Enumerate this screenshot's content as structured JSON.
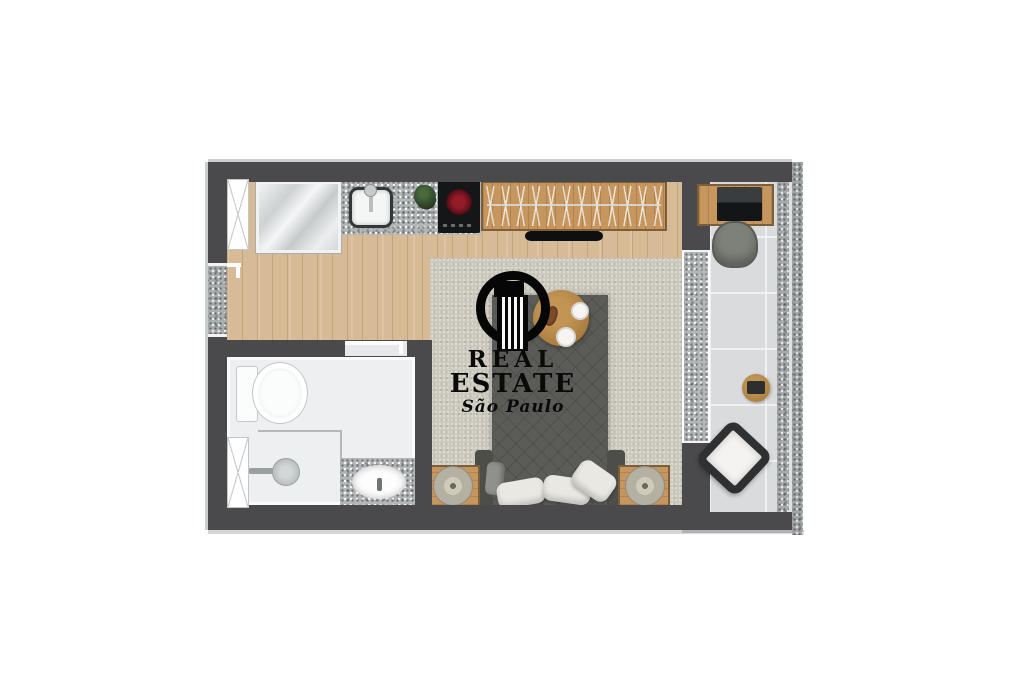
{
  "watermark": {
    "logo_icon": "building-in-ring-icon",
    "line1": "REAL",
    "line2": "ESTATE",
    "line3": "São Paulo",
    "text_color": "#0a0a0a"
  },
  "palette": {
    "background": "#ffffff",
    "wall": "#4a4a4c",
    "wood_floor": "#d7bb96",
    "furniture_wood": "#c6965f",
    "bathroom_floor": "#edeff0",
    "balcony_tile": "#d9dbdc",
    "granite": "#b3b6b7",
    "rug": "#cbc8bd",
    "bed_upholstery": "#5b5c57",
    "cooktop_black": "#151618",
    "burner_red": "#7e1520",
    "plant_green": "#3c5433"
  },
  "plan_icons": [
    "kitchen-window-icon",
    "refrigerator-icon",
    "kitchen-sink-icon",
    "faucet-icon",
    "plant-icon",
    "cooktop-icon",
    "wardrobe-icon",
    "tv-icon",
    "entry-door-icon",
    "rug-icon",
    "bed-icon",
    "pillow-icon",
    "breakfast-table-icon",
    "plate-icon",
    "nightstand-icon",
    "lamp-icon",
    "toilet-icon",
    "shower-icon",
    "bathroom-sink-icon",
    "bathroom-window-icon",
    "bathroom-door-icon",
    "desk-icon",
    "laptop-icon",
    "desk-chair-icon",
    "side-table-icon",
    "armchair-icon",
    "sliding-door-icon"
  ]
}
